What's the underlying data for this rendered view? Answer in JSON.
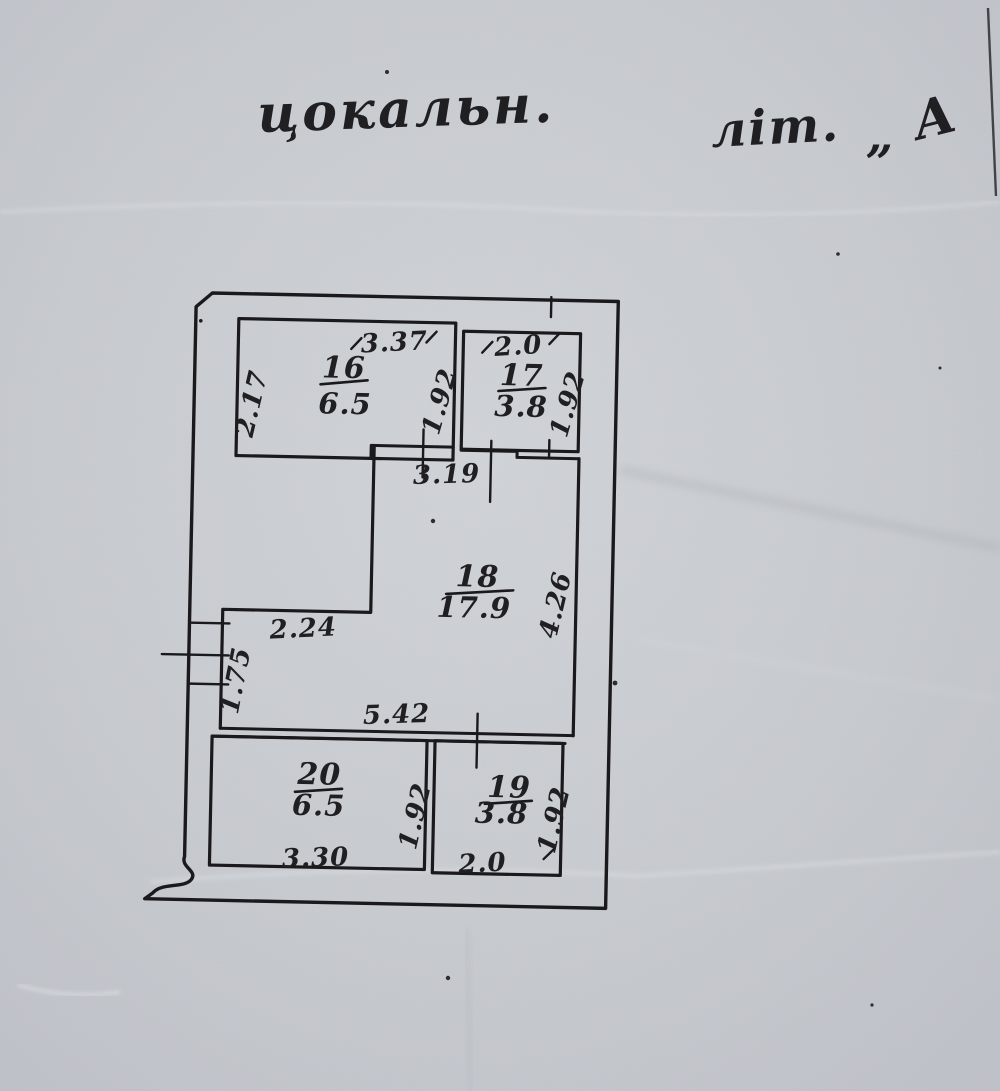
{
  "document": {
    "handwritten_title": "цокальн.",
    "handwritten_label": "літ.",
    "handwritten_quote": "„",
    "handwritten_letter": "А"
  },
  "rooms": {
    "r16": {
      "number": "16",
      "area": "6.5"
    },
    "r17": {
      "number": "17",
      "area": "3.8"
    },
    "r18": {
      "number": "18",
      "area": "17.9"
    },
    "r19": {
      "number": "19",
      "area": "3.8"
    },
    "r20": {
      "number": "20",
      "area": "6.5"
    }
  },
  "dimensions": {
    "d16_top": "3.37",
    "d16_left": "2.17",
    "d16_right": "1.92",
    "d17_top": "2.0",
    "d17_right": "1.92",
    "d18_top": "3.19",
    "d18_right": "4.26",
    "d18_step": "2.24",
    "d18_left": "1.75",
    "d18_bottom": "5.42",
    "d20_bottom": "3.30",
    "d20_right": "1.92",
    "d19_bottom": "2.0",
    "d19_right": "1.92"
  },
  "colors": {
    "paper": "#cbced3",
    "ink": "#1d1d20"
  }
}
